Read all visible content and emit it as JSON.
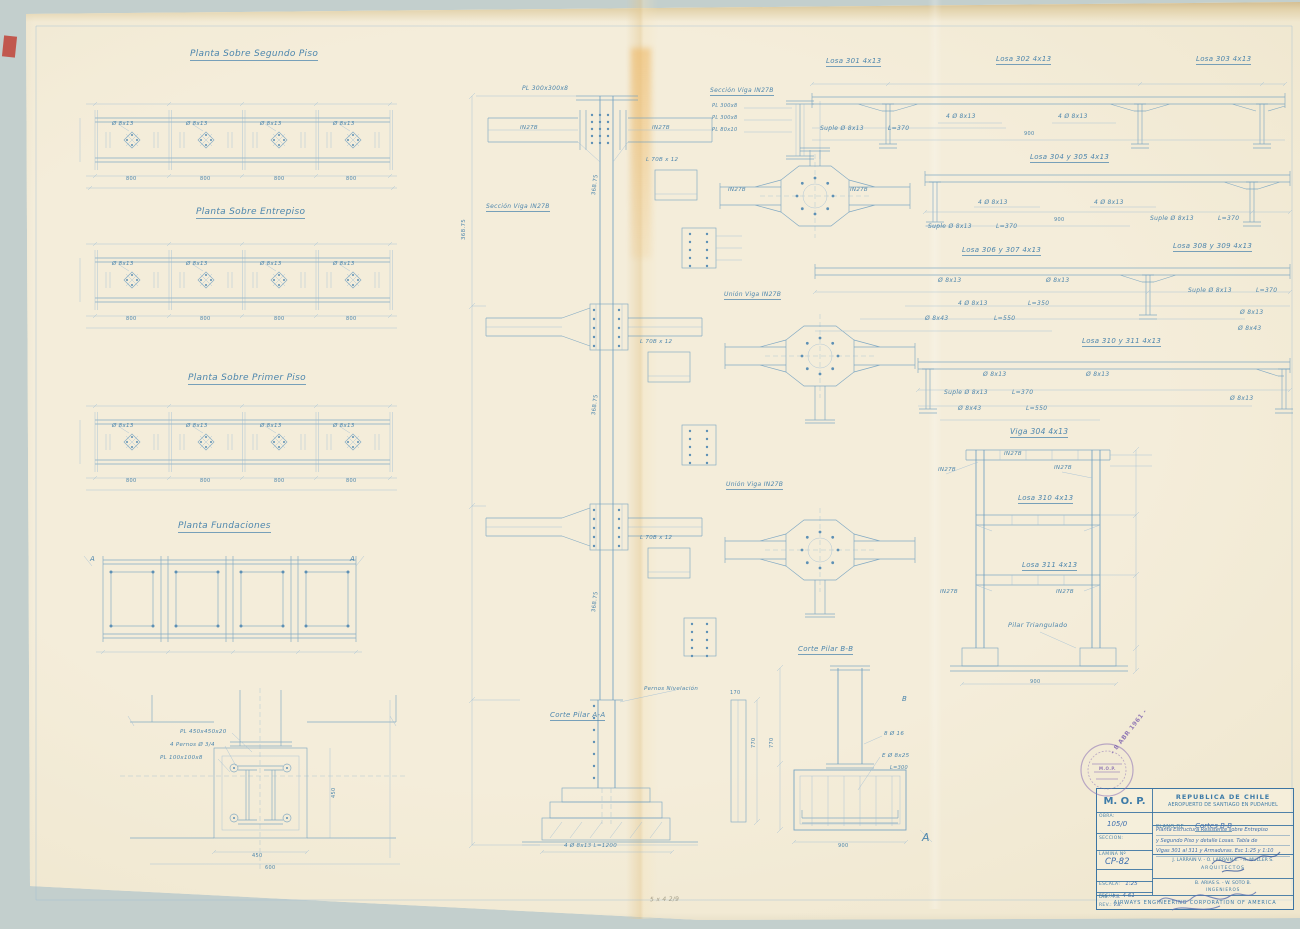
{
  "sheet": {
    "plan_titles": {
      "p1": "Planta Sobre Segundo Piso",
      "p2": "Planta Sobre Entrepiso",
      "p3": "Planta Sobre Primer Piso",
      "p4": "Planta Fundaciones"
    },
    "plan_callout": "Ø 8x13",
    "section_marker": "A"
  },
  "dims": {
    "d170": "170",
    "d368": "368.75",
    "d450": "450",
    "d600": "600",
    "d770": "770",
    "d800": "800",
    "d900": "900"
  },
  "cal": {
    "o813": "Ø 8x13",
    "c4o813": "4 Ø 8x13",
    "suple": "Suple Ø 8x13",
    "l370": "L=370",
    "l350": "L=350",
    "l550": "L=550",
    "o843": "Ø 8x43"
  },
  "losas": {
    "l301": "Losa 301 4x13",
    "l302": "Losa 302 4x13",
    "l303": "Losa 303 4x13",
    "l304_305": "Losa 304 y 305 4x13",
    "l306_307": "Losa 306 y 307 4x13",
    "l308_309": "Losa 308 y 309 4x13",
    "l310_311": "Losa 310 y 311 4x13"
  },
  "frame": {
    "title": "Viga 304 4x13",
    "losa310": "Losa 310 4x13",
    "losa311": "Losa 311 4x13",
    "pilar": "Pilar Triangulado",
    "profile": "IN27B"
  },
  "details": {
    "pl300300": "PL 300x300x8",
    "seccion_viga": "Sección Viga IN27B",
    "union_viga": "Unión Viga IN27B",
    "l70": "L 70B x 12",
    "pl3008": "PL 300x8",
    "pl8010": "PL 80x10",
    "corte_a": "Corte Pilar A-A",
    "corte_b": "Corte Pilar B-B",
    "pernos_niv": "Pernos Nivelación",
    "rebar_footing": "4 Ø 8x13 L=1200",
    "pl450": "PL 450x450x20",
    "pernos34": "4 Pernos Ø 3/4",
    "pl100": "PL 100x100x8",
    "r8o16": "8 Ø 16",
    "eo825": "E Ø 8x25",
    "l300": "L=300",
    "marker_a": "A",
    "marker_b": "B"
  },
  "titleblock": {
    "org": "M. O. P.",
    "country": "REPUBLICA DE CHILE",
    "project": "AEROPUERTO DE SANTIAGO EN PUDAHUEL",
    "obra_label": "OBRA:",
    "obra_value": "105/0",
    "seccion_label": "SECCION:",
    "plano_label": "PLANO DE",
    "plano_value": "Cortes B-B",
    "desc1": "Planta Estructura Resistente sobre Entrepiso",
    "desc2": "y Segundo Piso y detalle Losas. Tabla de",
    "desc3": "Vigas 301 al 311 y Armaduras. Esc 1:25 y 1:10",
    "lamina_label": "LAMINA Nº",
    "lamina_value": "CP-82",
    "escala_label": "ESCALA:",
    "escala_value": "1:25",
    "fecha_label": "FECHA:",
    "fecha_value": "4-61",
    "dib_label": "DIB.:",
    "dib_value": "F.S.",
    "rev_label": "REV.:",
    "rev_value": "V.B.",
    "architects": "J. LARRAIN V. - O. LARRAIN E. - R. MULLER S.",
    "architects_role": "ARQUITECTOS",
    "engineers": "B. ARIAS S. - W. SOTO B.",
    "engineers_role": "INGENIEROS",
    "footer": "AIRWAYS ENGINEERING CORPORATION OF AMERICA"
  },
  "stamp": {
    "org": "M.O.P.",
    "date": "- 8 ABR 1961 -"
  },
  "pencil_note": "5 x 4 2/9"
}
